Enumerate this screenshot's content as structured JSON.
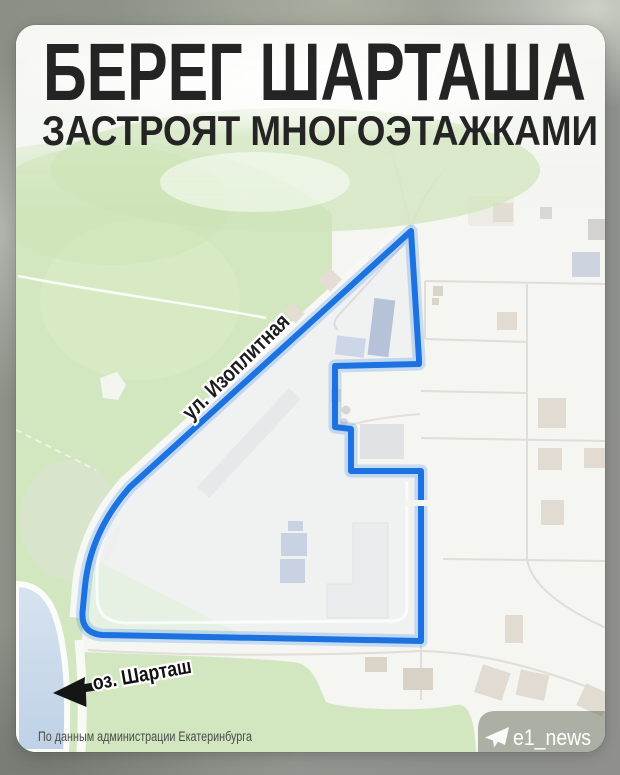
{
  "title": {
    "line1": "БЕРЕГ ШАРТАША",
    "line2": "ЗАСТРОЯТ МНОГОЭТАЖКАМИ"
  },
  "map": {
    "street_label": "ул. Изоплитная",
    "lake_label": "оз. Шарташ"
  },
  "footer": {
    "attribution": "По данным администрации Екатеринбурга",
    "watermark": "e1_news"
  },
  "colors": {
    "boundary_blue": "#1b72e0",
    "park_green": "#d2e7bf",
    "lake_blue": "#c9d9ea",
    "frame_gray": "#8e938b",
    "title_text": "#242424"
  }
}
